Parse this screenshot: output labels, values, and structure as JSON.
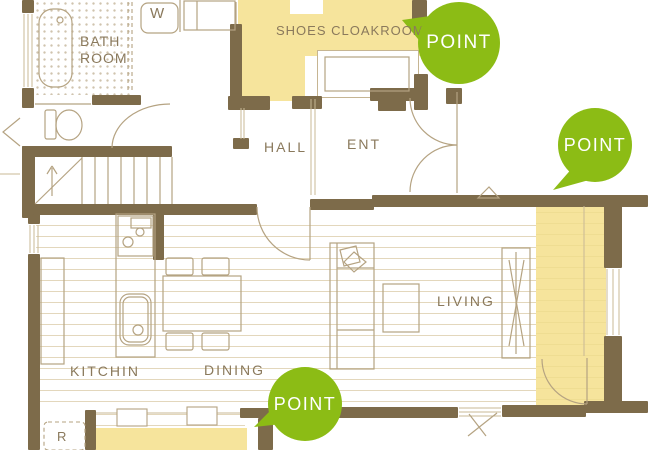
{
  "rooms": {
    "bath_line1": "BATH",
    "bath_line2": "ROOM",
    "washer": "W",
    "shoes_cloakroom": "SHOES CLOAKROOM",
    "hall": "HALL",
    "entrance": "ENT",
    "living": "LIVING",
    "kitchen": "KITCHIN",
    "dining": "DINING",
    "fridge": "R"
  },
  "badges": [
    {
      "label": "POINT"
    },
    {
      "label": "POINT"
    },
    {
      "label": "POINT"
    }
  ],
  "colors": {
    "wall": "#7d6b4a",
    "highlight": "#f6e49c",
    "badge_green": "#8cbc15",
    "line": "#b5a382",
    "label_text": "#8a795c",
    "floor_line": "#e3d7bc"
  }
}
